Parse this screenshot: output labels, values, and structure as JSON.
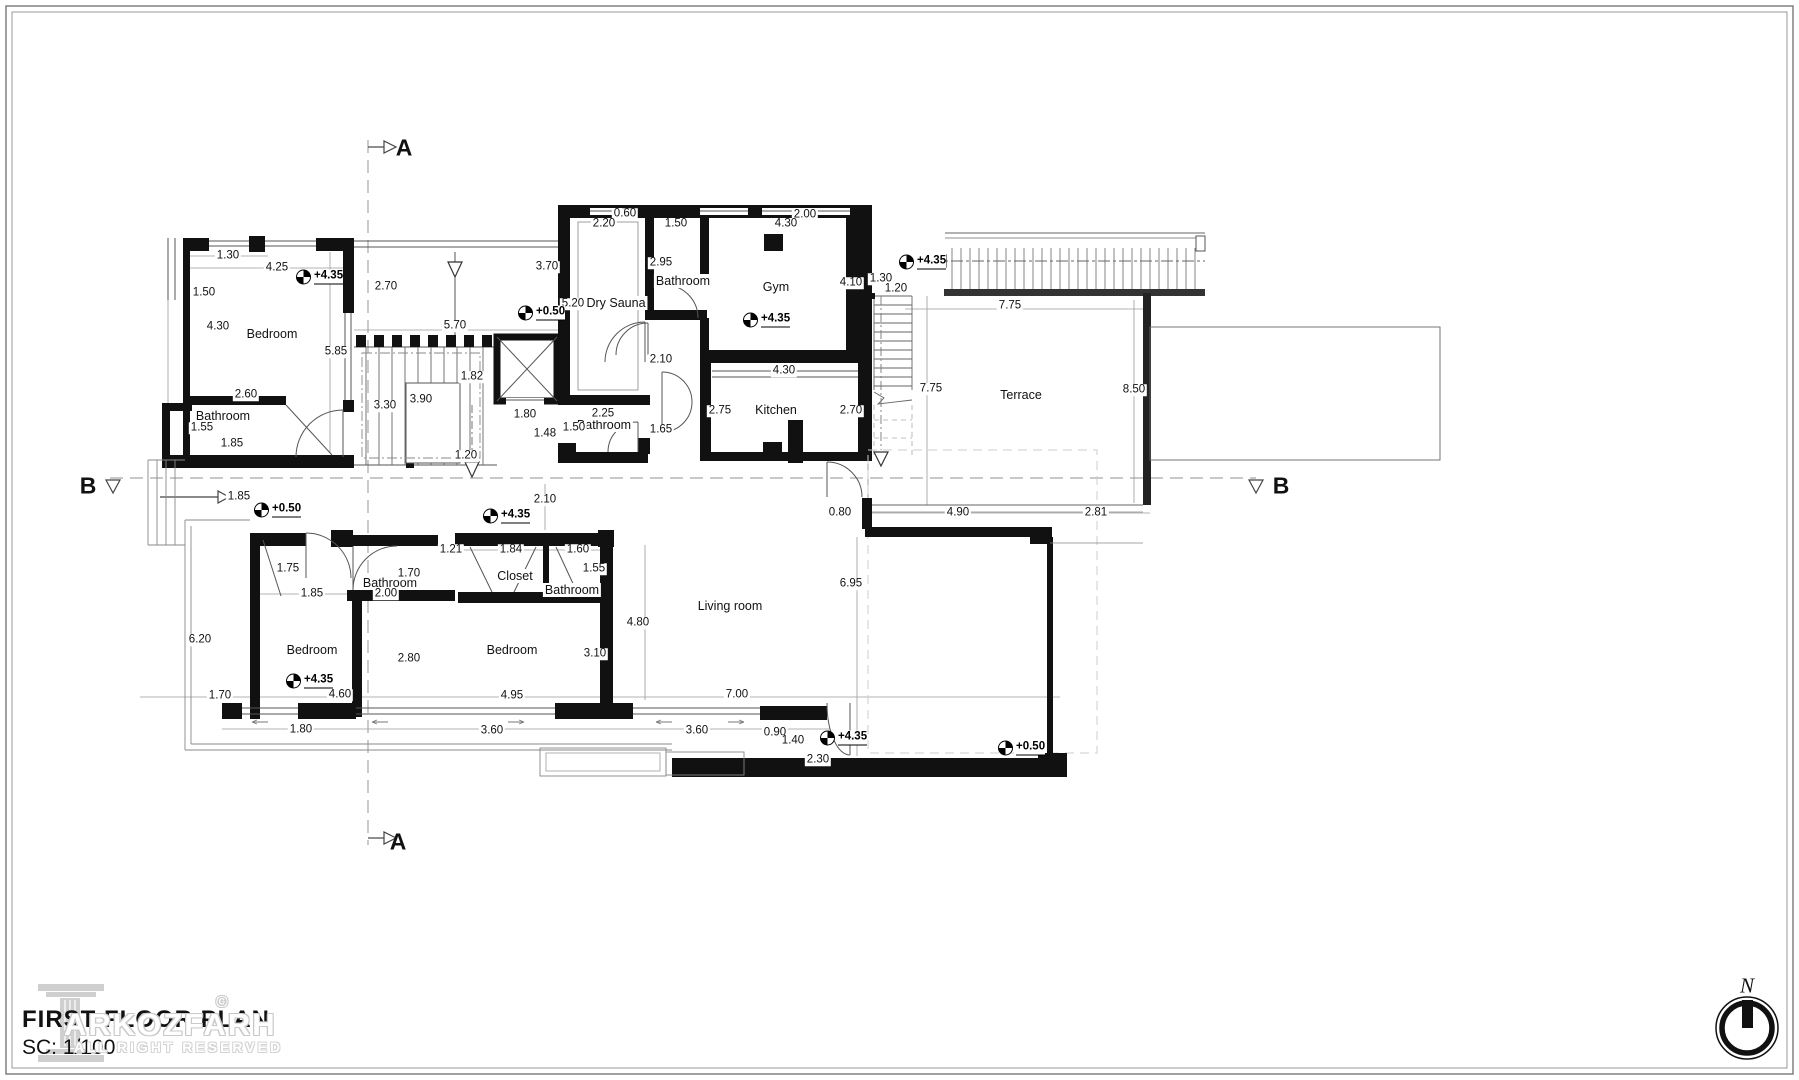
{
  "drawing": {
    "title": "FIRST FLOOR PLAN",
    "scale_label": "SC: 1/100"
  },
  "watermark": {
    "brand": "ARKOZFARH",
    "copyright": "©",
    "rights": "ALL RIGHT RESERVED"
  },
  "compass": {
    "label": "N"
  },
  "colors": {
    "wall": "#111111",
    "thin": "#555555",
    "witness": "#999999",
    "section_dash": "#a8a8a8",
    "watermark": "#c9c9c9"
  },
  "sections": [
    {
      "label": "A",
      "x": 404,
      "y": 148
    },
    {
      "label": "A",
      "x": 398,
      "y": 842
    },
    {
      "label": "B",
      "x": 88,
      "y": 486
    },
    {
      "label": "B",
      "x": 1281,
      "y": 486
    }
  ],
  "rooms": [
    {
      "name": "Bedroom",
      "x": 272,
      "y": 334
    },
    {
      "name": "Bathroom",
      "x": 223,
      "y": 416
    },
    {
      "name": "Dry Sauna",
      "x": 616,
      "y": 303
    },
    {
      "name": "Bathroom",
      "x": 683,
      "y": 281
    },
    {
      "name": "Gym",
      "x": 776,
      "y": 287
    },
    {
      "name": "Kitchen",
      "x": 776,
      "y": 410
    },
    {
      "name": "Bathroom",
      "x": 604,
      "y": 425
    },
    {
      "name": "Terrace",
      "x": 1021,
      "y": 395
    },
    {
      "name": "Bedroom",
      "x": 312,
      "y": 650
    },
    {
      "name": "Bathroom",
      "x": 390,
      "y": 583
    },
    {
      "name": "Closet",
      "x": 515,
      "y": 576
    },
    {
      "name": "Bathroom",
      "x": 572,
      "y": 590
    },
    {
      "name": "Bedroom",
      "x": 512,
      "y": 650
    },
    {
      "name": "Living room",
      "x": 730,
      "y": 606
    }
  ],
  "levels": [
    {
      "value": "+4.35",
      "x": 300,
      "y": 277
    },
    {
      "value": "+0.50",
      "x": 522,
      "y": 313
    },
    {
      "value": "+4.35",
      "x": 747,
      "y": 320
    },
    {
      "value": "+4.35",
      "x": 903,
      "y": 262
    },
    {
      "value": "+0.50",
      "x": 258,
      "y": 510
    },
    {
      "value": "+4.35",
      "x": 487,
      "y": 516
    },
    {
      "value": "+4.35",
      "x": 290,
      "y": 681
    },
    {
      "value": "+4.35",
      "x": 824,
      "y": 738
    },
    {
      "value": "+0.50",
      "x": 1002,
      "y": 748
    }
  ],
  "dimensions": [
    {
      "value": "1.30",
      "x": 228,
      "y": 256
    },
    {
      "value": "4.25",
      "x": 277,
      "y": 268
    },
    {
      "value": "1.50",
      "x": 204,
      "y": 293
    },
    {
      "value": "4.30",
      "x": 218,
      "y": 327
    },
    {
      "value": "5.85",
      "x": 336,
      "y": 352
    },
    {
      "value": "2.60",
      "x": 246,
      "y": 395
    },
    {
      "value": "1.55",
      "x": 202,
      "y": 428
    },
    {
      "value": "1.85",
      "x": 232,
      "y": 444
    },
    {
      "value": "2.70",
      "x": 386,
      "y": 287
    },
    {
      "value": "3.70",
      "x": 547,
      "y": 267
    },
    {
      "value": "5.70",
      "x": 455,
      "y": 326
    },
    {
      "value": "3.30",
      "x": 385,
      "y": 406
    },
    {
      "value": "3.90",
      "x": 421,
      "y": 400
    },
    {
      "value": "1.82",
      "x": 472,
      "y": 377
    },
    {
      "value": "1.20",
      "x": 466,
      "y": 456
    },
    {
      "value": "0.60",
      "x": 625,
      "y": 214
    },
    {
      "value": "2.20",
      "x": 604,
      "y": 224
    },
    {
      "value": "1.50",
      "x": 676,
      "y": 224
    },
    {
      "value": "2.00",
      "x": 805,
      "y": 215
    },
    {
      "value": "4.30",
      "x": 786,
      "y": 224
    },
    {
      "value": "5.20",
      "x": 573,
      "y": 304
    },
    {
      "value": "2.95",
      "x": 661,
      "y": 263
    },
    {
      "value": "2.10",
      "x": 661,
      "y": 360
    },
    {
      "value": "4.10",
      "x": 851,
      "y": 283
    },
    {
      "value": "1.30",
      "x": 881,
      "y": 279
    },
    {
      "value": "1.20",
      "x": 896,
      "y": 289
    },
    {
      "value": "2.70",
      "x": 851,
      "y": 411
    },
    {
      "value": "4.30",
      "x": 784,
      "y": 371
    },
    {
      "value": "2.75",
      "x": 720,
      "y": 411
    },
    {
      "value": "2.25",
      "x": 603,
      "y": 414
    },
    {
      "value": "1.50",
      "x": 574,
      "y": 428
    },
    {
      "value": "1.65",
      "x": 661,
      "y": 430
    },
    {
      "value": "1.80",
      "x": 525,
      "y": 415
    },
    {
      "value": "1.48",
      "x": 545,
      "y": 434
    },
    {
      "value": "7.75",
      "x": 1010,
      "y": 306
    },
    {
      "value": "7.75",
      "x": 931,
      "y": 389
    },
    {
      "value": "8.50",
      "x": 1134,
      "y": 390
    },
    {
      "value": "2.10",
      "x": 545,
      "y": 500
    },
    {
      "value": "1.85",
      "x": 239,
      "y": 497
    },
    {
      "value": "0.80",
      "x": 840,
      "y": 513
    },
    {
      "value": "4.90",
      "x": 958,
      "y": 513
    },
    {
      "value": "2.81",
      "x": 1096,
      "y": 513
    },
    {
      "value": "6.95",
      "x": 851,
      "y": 584
    },
    {
      "value": "1.75",
      "x": 288,
      "y": 569
    },
    {
      "value": "1.70",
      "x": 409,
      "y": 574
    },
    {
      "value": "1.21",
      "x": 451,
      "y": 550
    },
    {
      "value": "1.84",
      "x": 511,
      "y": 550
    },
    {
      "value": "1.60",
      "x": 578,
      "y": 550
    },
    {
      "value": "1.55",
      "x": 594,
      "y": 569
    },
    {
      "value": "1.85",
      "x": 312,
      "y": 594
    },
    {
      "value": "2.00",
      "x": 386,
      "y": 594
    },
    {
      "value": "6.20",
      "x": 200,
      "y": 640
    },
    {
      "value": "2.80",
      "x": 409,
      "y": 659
    },
    {
      "value": "3.10",
      "x": 595,
      "y": 654
    },
    {
      "value": "4.80",
      "x": 638,
      "y": 623
    },
    {
      "value": "1.70",
      "x": 220,
      "y": 696
    },
    {
      "value": "4.60",
      "x": 340,
      "y": 695
    },
    {
      "value": "4.95",
      "x": 512,
      "y": 696
    },
    {
      "value": "7.00",
      "x": 737,
      "y": 695
    },
    {
      "value": "1.80",
      "x": 301,
      "y": 730
    },
    {
      "value": "3.60",
      "x": 492,
      "y": 731
    },
    {
      "value": "3.60",
      "x": 697,
      "y": 731
    },
    {
      "value": "0.90",
      "x": 775,
      "y": 733
    },
    {
      "value": "1.40",
      "x": 793,
      "y": 741
    },
    {
      "value": "2.30",
      "x": 818,
      "y": 760
    }
  ]
}
